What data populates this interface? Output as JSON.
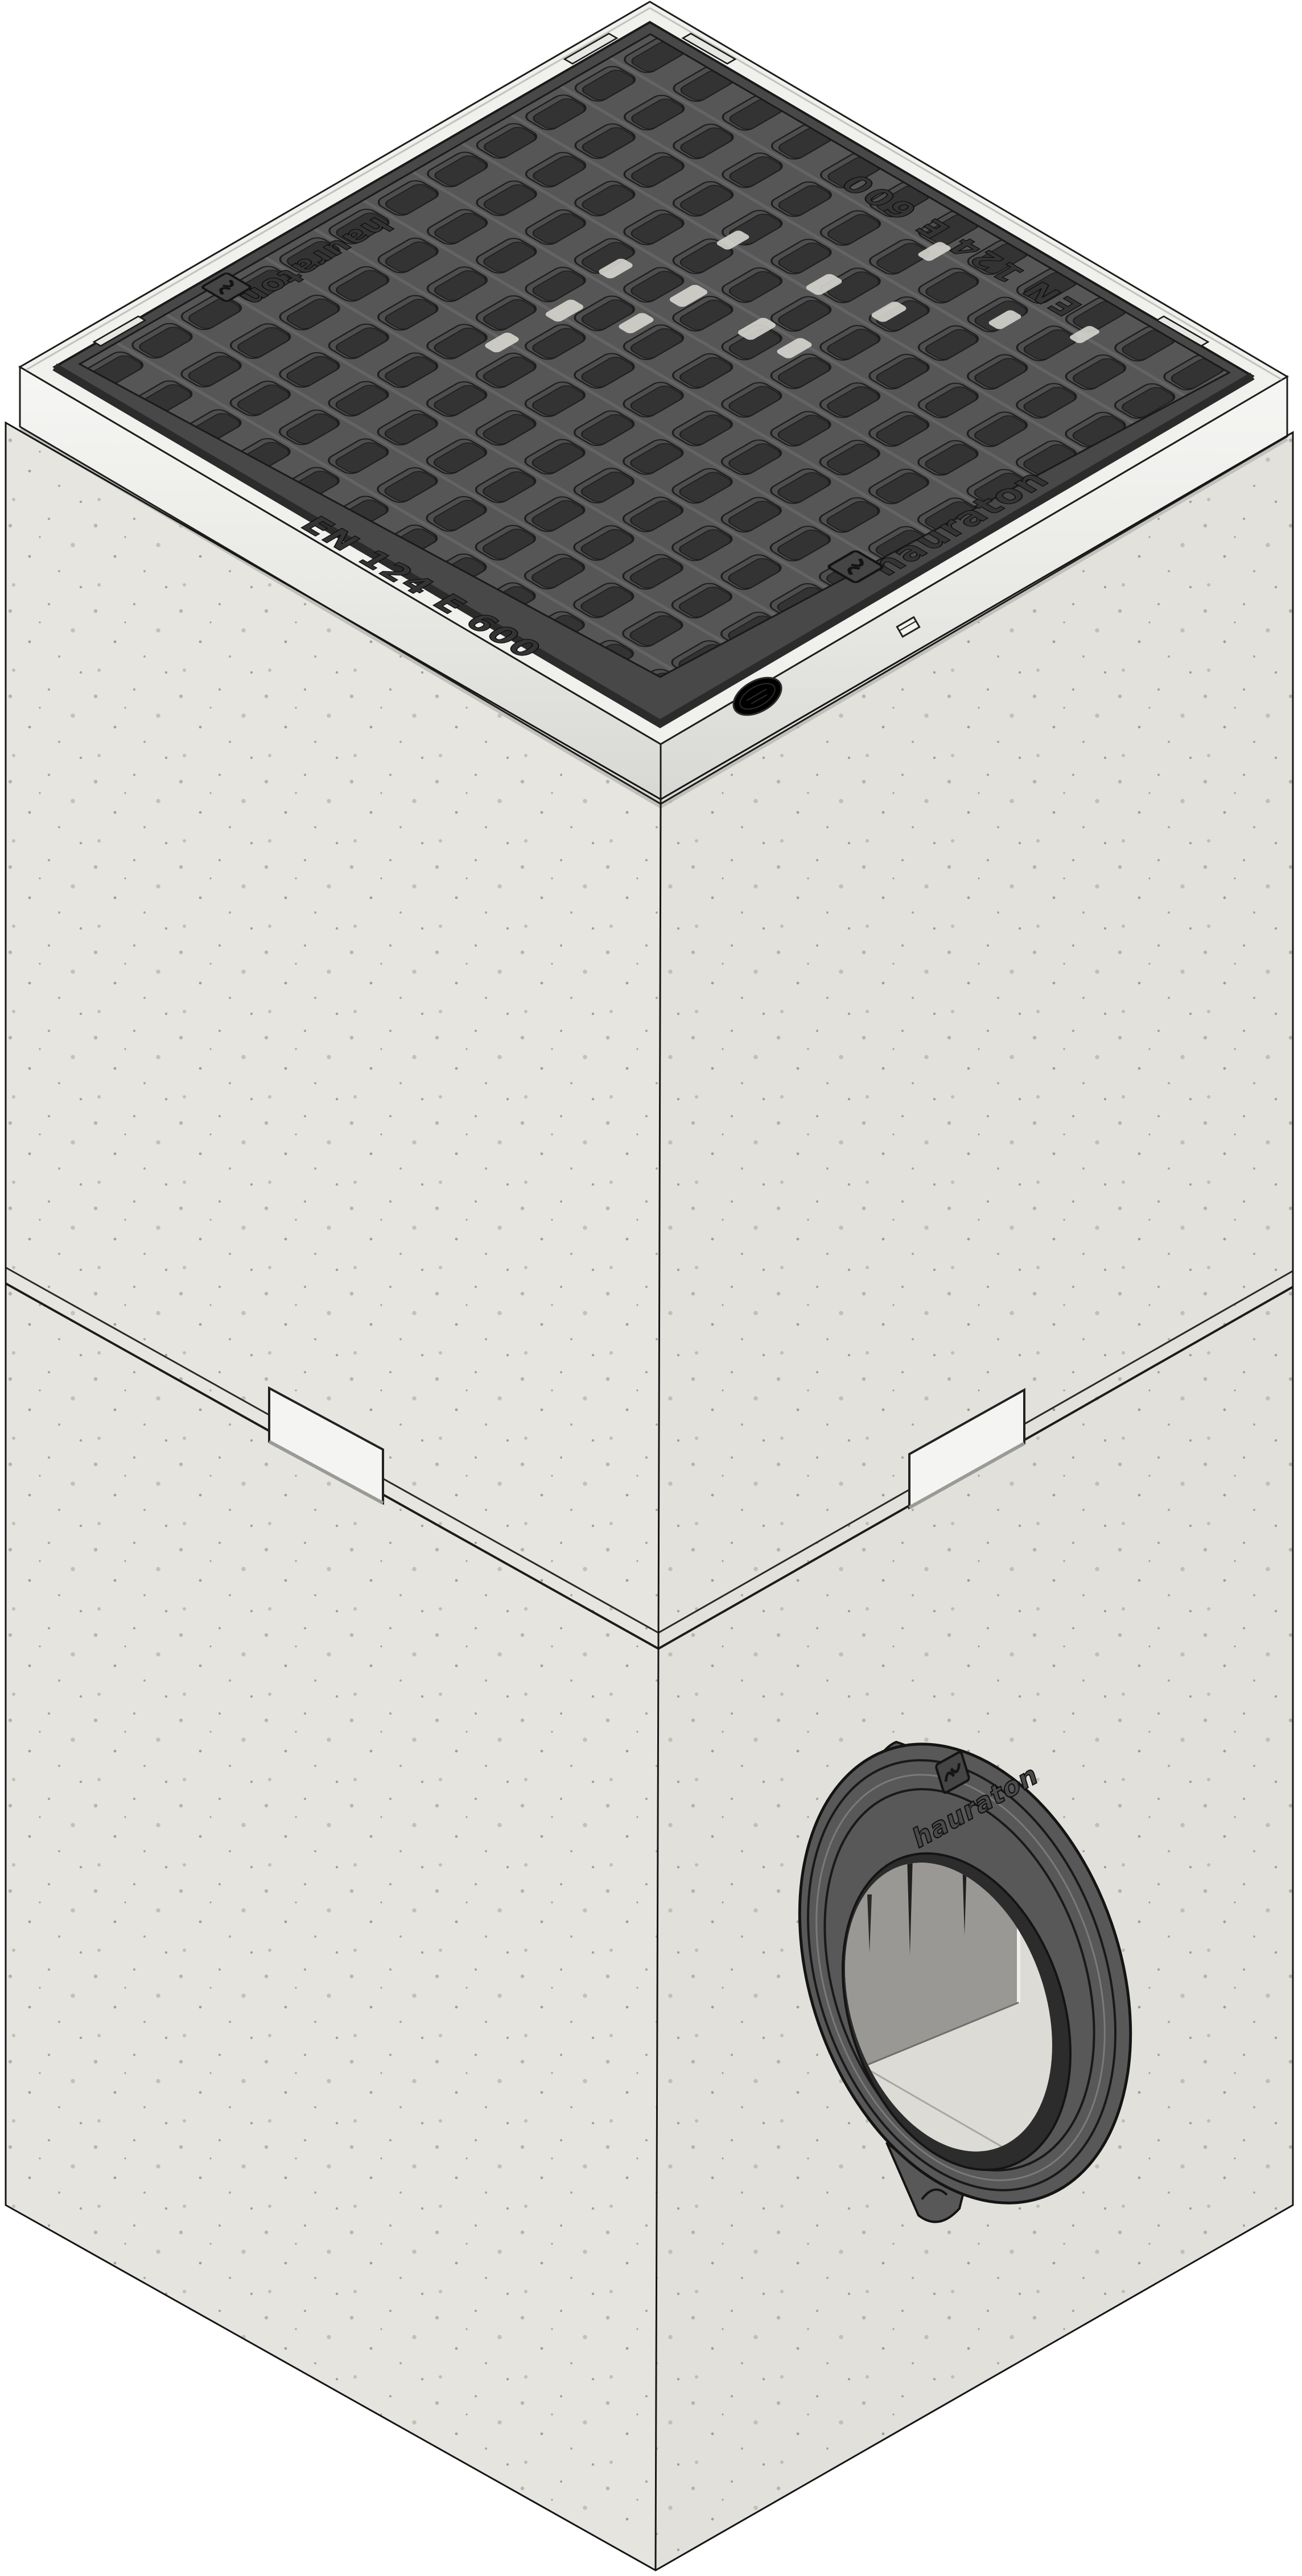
{
  "product": {
    "description": "Concrete drainage trash box with ductile iron mesh grating, galvanized angle frame and oval pipe outlet seal"
  },
  "markings": {
    "grate_front_left": "EN 124 E 600",
    "grate_front_right_brand": "hauraton",
    "grate_back_left_brand": "hauraton",
    "grate_back_right": "EN 124 E 600",
    "outlet_brand": "hauraton"
  },
  "icons": {
    "brand_logo": "hauraton-square-logo"
  },
  "colors": {
    "background": "#ffffff",
    "concrete_left_upper": "#e6e5e0",
    "concrete_right_upper": "#e2e1db",
    "concrete_left_lower": "#e5e4df",
    "concrete_right_lower": "#e1e0da",
    "frame_band": "#f0f0ed",
    "frame_skirt_left": "#ebebe8",
    "frame_skirt_right": "#e3e3e0",
    "grate_border": "#484848",
    "grate_bar": "#565656",
    "grate_slot": "#333333",
    "outline_dark": "#161616",
    "clip_metal": "#f4f4f2",
    "outlet_body": "#585858",
    "interior_light": "#dcdbd6",
    "interior_wall": "#999894"
  }
}
